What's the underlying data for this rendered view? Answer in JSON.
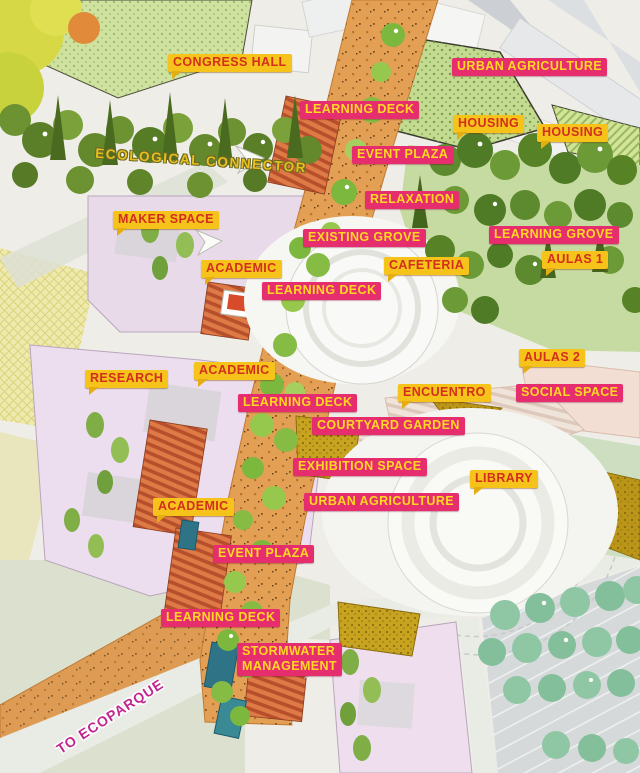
{
  "colors": {
    "yellow_bg": "#F6C31A",
    "yellow_text": "#D32F1E",
    "pink_bg": "#E62E6E",
    "pink_text": "#FFD821",
    "connector_text": "#E9C01B",
    "ecoparque_text": "#C2258F"
  },
  "labels": [
    {
      "name": "congress-hall-label",
      "text": "CONGRESS HALL",
      "style": "yellow",
      "x": 168,
      "y": 54
    },
    {
      "name": "ecological-connector-label",
      "text": "ECOLOGICAL CONNECTOR",
      "style": "text-yellow",
      "x": 95,
      "y": 153,
      "rotate": 4
    },
    {
      "name": "urban-agriculture-top-label",
      "text": "URBAN AGRICULTURE",
      "style": "pink",
      "x": 452,
      "y": 58
    },
    {
      "name": "learning-deck-1-label",
      "text": "LEARNING DECK",
      "style": "pink",
      "x": 300,
      "y": 101
    },
    {
      "name": "housing-1-label",
      "text": "HOUSING",
      "style": "yellow",
      "x": 453,
      "y": 115
    },
    {
      "name": "housing-2-label",
      "text": "HOUSING",
      "style": "yellow",
      "x": 537,
      "y": 124
    },
    {
      "name": "event-plaza-1-label",
      "text": "EVENT PLAZA",
      "style": "pink",
      "x": 352,
      "y": 146
    },
    {
      "name": "relaxation-label",
      "text": "RELAXATION",
      "style": "pink",
      "x": 365,
      "y": 191
    },
    {
      "name": "maker-space-label",
      "text": "MAKER SPACE",
      "style": "yellow",
      "x": 113,
      "y": 211
    },
    {
      "name": "learning-grove-label",
      "text": "LEARNING GROVE",
      "style": "pink",
      "x": 489,
      "y": 226
    },
    {
      "name": "existing-grove-label",
      "text": "EXISTING GROVE",
      "style": "pink",
      "x": 303,
      "y": 229
    },
    {
      "name": "aulas-1-label",
      "text": "AULAS 1",
      "style": "yellow",
      "x": 542,
      "y": 251
    },
    {
      "name": "cafeteria-label",
      "text": "CAFETERIA",
      "style": "yellow",
      "x": 384,
      "y": 257
    },
    {
      "name": "academic-1-label",
      "text": "ACADEMIC",
      "style": "yellow",
      "x": 201,
      "y": 260
    },
    {
      "name": "learning-deck-2-label",
      "text": "LEARNING DECK",
      "style": "pink",
      "x": 262,
      "y": 282
    },
    {
      "name": "aulas-2-label",
      "text": "AULAS 2",
      "style": "yellow",
      "x": 519,
      "y": 349
    },
    {
      "name": "academic-2-label",
      "text": "ACADEMIC",
      "style": "yellow",
      "x": 194,
      "y": 362
    },
    {
      "name": "research-label",
      "text": "RESEARCH",
      "style": "yellow",
      "x": 85,
      "y": 370
    },
    {
      "name": "encuentro-label",
      "text": "ENCUENTRO",
      "style": "yellow",
      "x": 398,
      "y": 384
    },
    {
      "name": "social-space-label",
      "text": "SOCIAL SPACE",
      "style": "pink",
      "x": 516,
      "y": 384
    },
    {
      "name": "learning-deck-3-label",
      "text": "LEARNING DECK",
      "style": "pink",
      "x": 238,
      "y": 394
    },
    {
      "name": "courtyard-garden-label",
      "text": "COURTYARD GARDEN",
      "style": "pink",
      "x": 312,
      "y": 417
    },
    {
      "name": "exhibition-space-label",
      "text": "EXHIBITION SPACE",
      "style": "pink",
      "x": 293,
      "y": 458
    },
    {
      "name": "library-label",
      "text": "LIBRARY",
      "style": "yellow",
      "x": 470,
      "y": 470
    },
    {
      "name": "urban-agriculture-mid-label",
      "text": "URBAN AGRICULTURE",
      "style": "pink",
      "x": 304,
      "y": 493
    },
    {
      "name": "academic-3-label",
      "text": "ACADEMIC",
      "style": "yellow",
      "x": 153,
      "y": 498
    },
    {
      "name": "event-plaza-2-label",
      "text": "EVENT PLAZA",
      "style": "pink",
      "x": 213,
      "y": 545
    },
    {
      "name": "learning-deck-4-label",
      "text": "LEARNING DECK",
      "style": "pink",
      "x": 161,
      "y": 609
    },
    {
      "name": "stormwater-management-label",
      "text": "STORMWATER\nMANAGEMENT",
      "style": "pink",
      "x": 237,
      "y": 643
    },
    {
      "name": "to-ecoparque-label",
      "text": "TO ECOPARQUE",
      "style": "text-magenta",
      "x": 58,
      "y": 742,
      "rotate": -33
    }
  ]
}
